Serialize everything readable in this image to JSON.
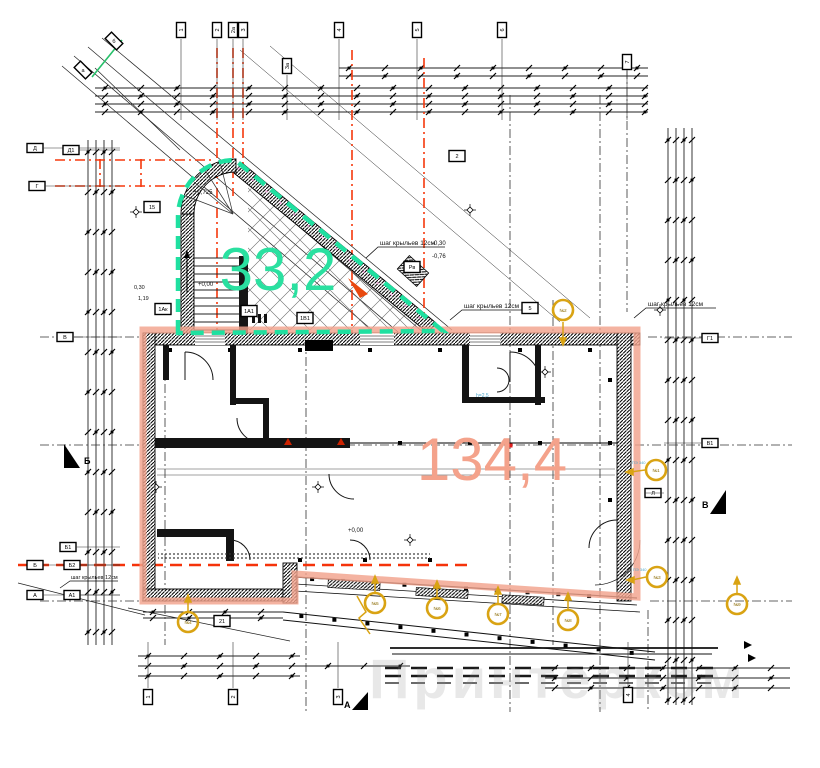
{
  "colors": {
    "teal": "#1fe0a0",
    "salmon": "#f2a28c",
    "red": "#f5380d",
    "yellow": "#d9a313",
    "cyan": "#4fa8cc",
    "ink": "#141414",
    "watermark": "#8f8f8f"
  },
  "areas": {
    "wing_area": "33,2",
    "main_area": "134,4"
  },
  "annotations": {
    "step_note_1": "шаг крыльев 12см",
    "step_note_2": "шаг крыльев 12см",
    "step_note_3": "шаг крыльев 12см",
    "step_note_4": "шаг крыльев 12см",
    "marker_note": "ПЭ 340",
    "height_note": "h=2,5",
    "elevations": {
      "stair_base": "+0,00",
      "stair_top": "+0,725",
      "ramp_top": "-0,30",
      "ramp_mid": "-0,76",
      "floor": "+0,00",
      "dim_a": "0,30",
      "dim_b": "1,19"
    }
  },
  "watermark": "Принтерком",
  "markers": {
    "bubbles_top": [
      {
        "x": 181,
        "y": 30,
        "label": "1",
        "rot": true
      },
      {
        "x": 217,
        "y": 30,
        "label": "2",
        "rot": true
      },
      {
        "x": 233,
        "y": 30,
        "label": "2а",
        "rot": true
      },
      {
        "x": 243,
        "y": 30,
        "label": "3",
        "rot": true
      },
      {
        "x": 339,
        "y": 30,
        "label": "4",
        "rot": true
      },
      {
        "x": 417,
        "y": 30,
        "label": "5",
        "rot": true
      },
      {
        "x": 502,
        "y": 30,
        "label": "6",
        "rot": true
      },
      {
        "x": 287,
        "y": 66,
        "label": "3а",
        "rot": true
      },
      {
        "x": 627,
        "y": 62,
        "label": "7",
        "rot": true
      }
    ],
    "bubbles_diag": [
      {
        "x": 83,
        "y": 70,
        "label": "а"
      },
      {
        "x": 114,
        "y": 41,
        "label": "б"
      }
    ],
    "bubbles_left": [
      {
        "x": 35,
        "y": 148,
        "label": "Д"
      },
      {
        "x": 71,
        "y": 150,
        "label": "Д1"
      },
      {
        "x": 37,
        "y": 186,
        "label": "Г"
      },
      {
        "x": 65,
        "y": 337,
        "label": "В"
      },
      {
        "x": 68,
        "y": 547,
        "label": "Б1"
      },
      {
        "x": 35,
        "y": 565,
        "label": "Б"
      },
      {
        "x": 72,
        "y": 565,
        "label": "Б2"
      },
      {
        "x": 35,
        "y": 595,
        "label": "А"
      },
      {
        "x": 72,
        "y": 595,
        "label": "А1"
      }
    ],
    "bubbles_right": [
      {
        "x": 710,
        "y": 338,
        "label": "Г1"
      },
      {
        "x": 710,
        "y": 443,
        "label": "В1"
      },
      {
        "x": 653,
        "y": 493,
        "label": "Л"
      }
    ],
    "bubbles_bottom": [
      {
        "x": 148,
        "y": 697,
        "label": "1",
        "rot": true
      },
      {
        "x": 233,
        "y": 697,
        "label": "2",
        "rot": true
      },
      {
        "x": 338,
        "y": 697,
        "label": "3",
        "rot": true
      },
      {
        "x": 628,
        "y": 695,
        "label": "4",
        "rot": true
      }
    ],
    "boxes": [
      {
        "x": 152,
        "y": 207,
        "label": "15"
      },
      {
        "x": 163,
        "y": 309,
        "label": "1Ак"
      },
      {
        "x": 249,
        "y": 311,
        "label": "1А1"
      },
      {
        "x": 305,
        "y": 318,
        "label": "1В1"
      },
      {
        "x": 412,
        "y": 267,
        "label": "Рв"
      },
      {
        "x": 457,
        "y": 156,
        "label": "2"
      },
      {
        "x": 530,
        "y": 308,
        "label": "5"
      },
      {
        "x": 222,
        "y": 621,
        "label": "21"
      }
    ],
    "circles": [
      {
        "x": 563,
        "y": 310,
        "label": "№2"
      },
      {
        "x": 656,
        "y": 470,
        "label": "№1",
        "note": true
      },
      {
        "x": 657,
        "y": 577,
        "label": "№3",
        "note": true
      },
      {
        "x": 188,
        "y": 622,
        "label": "№4"
      },
      {
        "x": 375,
        "y": 603,
        "label": "№5"
      },
      {
        "x": 437,
        "y": 608,
        "label": "№6"
      },
      {
        "x": 498,
        "y": 614,
        "label": "№7"
      },
      {
        "x": 568,
        "y": 620,
        "label": "№8"
      },
      {
        "x": 737,
        "y": 604,
        "label": "№9"
      }
    ],
    "sections": [
      {
        "x": 64,
        "y": 444,
        "letter": "Б",
        "dir": "left"
      },
      {
        "x": 710,
        "y": 490,
        "letter": "В",
        "dir": "right"
      },
      {
        "x": 352,
        "y": 692,
        "letter": "А",
        "dir": "bottom"
      }
    ]
  }
}
